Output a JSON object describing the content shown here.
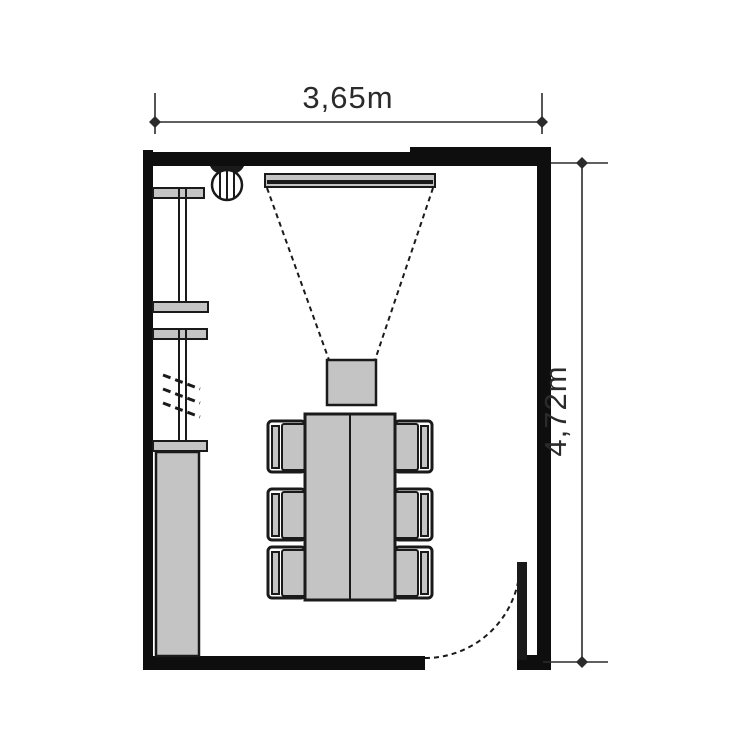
{
  "plan": {
    "type": "room-floor-plan",
    "dimensions": {
      "top_width_label": "3,65m",
      "right_height_label": "4,72m"
    },
    "colors": {
      "wall": "#0e0e0e",
      "line": "#1a1a1a",
      "furniture_fill": "#c4c4c4",
      "background": "#ffffff",
      "text": "#2b2b2b"
    },
    "symbols": {
      "lamp": "ceiling-lamp",
      "screen": "projection-screen",
      "projector": "projector",
      "table": "conference-table",
      "chairs_count": 6,
      "shelves_count": 4,
      "cabinet": "cabinet",
      "door": "door-swing",
      "rail": "hanging-rail-marks"
    }
  }
}
